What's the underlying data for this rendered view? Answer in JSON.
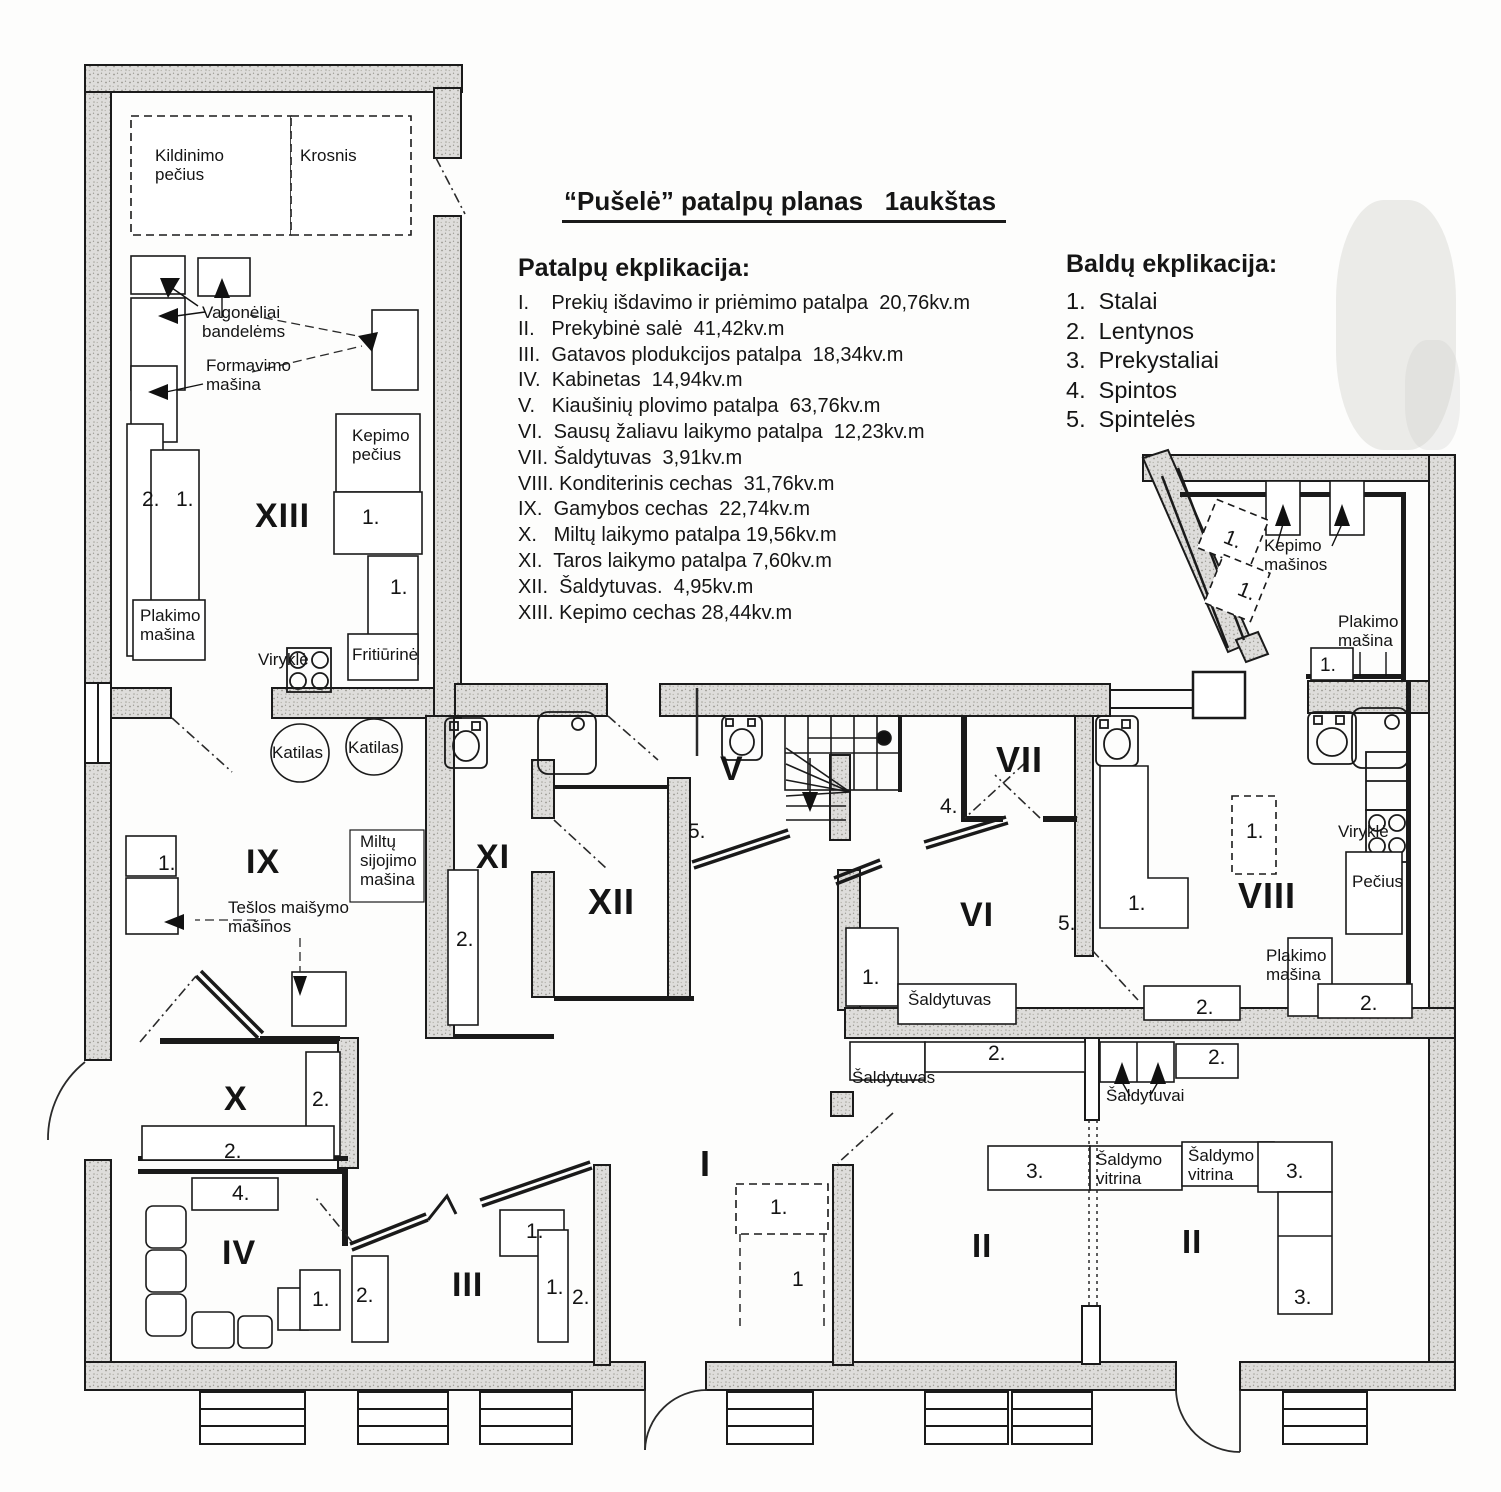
{
  "title": "“Pušelė” patalpų planas   1aukštas",
  "rooms_legend": {
    "heading": "Patalpų ekplikacija:",
    "items": [
      "I.    Prekių išdavimo ir priėmimo patalpa  20,76kv.m",
      "II.   Prekybinė salė  41,42kv.m",
      "III.  Gatavos plodukcijos patalpa  18,34kv.m",
      "IV.  Kabinetas  14,94kv.m",
      "V.   Kiaušinių plovimo patalpa  63,76kv.m",
      "VI.  Sausų žaliavu laikymo patalpa  12,23kv.m",
      "VII. Šaldytuvas  3,91kv.m",
      "VIII. Konditerinis cechas  31,76kv.m",
      "IX.  Gamybos cechas  22,74kv.m",
      "X.   Miltų laikymo patalpa 19,56kv.m",
      "XI.  Taros laikymo patalpa 7,60kv.m",
      "XII.  Šaldytuvas.  4,95kv.m",
      "XIII. Kepimo cechas 28,44kv.m"
    ]
  },
  "furniture_legend": {
    "heading": "Baldų ekplikacija:",
    "items": [
      "1.  Stalai",
      "2.  Lentynos",
      "3.  Prekystaliai",
      "4.  Spintos",
      "5.  Spintelės"
    ]
  },
  "room_labels": [
    {
      "name": "room-XIII",
      "text": "XIII",
      "x": 255,
      "y": 497,
      "fs": 34,
      "b": 1
    },
    {
      "name": "room-IX",
      "text": "IX",
      "x": 246,
      "y": 843,
      "fs": 34,
      "b": 1
    },
    {
      "name": "room-X",
      "text": "X",
      "x": 224,
      "y": 1080,
      "fs": 34,
      "b": 1
    },
    {
      "name": "room-IV",
      "text": "IV",
      "x": 222,
      "y": 1234,
      "fs": 34,
      "b": 1
    },
    {
      "name": "room-III",
      "text": "III",
      "x": 452,
      "y": 1266,
      "fs": 34,
      "b": 1
    },
    {
      "name": "room-XI",
      "text": "XI",
      "x": 476,
      "y": 838,
      "fs": 34,
      "b": 1
    },
    {
      "name": "room-XII",
      "text": "XII",
      "x": 588,
      "y": 882,
      "fs": 36,
      "b": 1
    },
    {
      "name": "room-V",
      "text": "V",
      "x": 720,
      "y": 750,
      "fs": 34,
      "b": 1
    },
    {
      "name": "room-VI",
      "text": "VI",
      "x": 960,
      "y": 896,
      "fs": 34,
      "b": 1
    },
    {
      "name": "room-VII",
      "text": "VII",
      "x": 996,
      "y": 740,
      "fs": 36,
      "b": 1
    },
    {
      "name": "room-VIII",
      "text": "VIII",
      "x": 1238,
      "y": 876,
      "fs": 36,
      "b": 1
    },
    {
      "name": "room-I",
      "text": "I",
      "x": 700,
      "y": 1144,
      "fs": 36,
      "b": 1
    },
    {
      "name": "room-II-left",
      "text": "II",
      "x": 972,
      "y": 1228,
      "fs": 33,
      "b": 1
    },
    {
      "name": "room-II-right",
      "text": "II",
      "x": 1182,
      "y": 1224,
      "fs": 33,
      "b": 1
    }
  ],
  "equipment_labels": [
    {
      "name": "lbl-kildinimo-pecius",
      "text": "Kildinimo\npečius",
      "x": 155,
      "y": 146
    },
    {
      "name": "lbl-krosnis",
      "text": "Krosnis",
      "x": 300,
      "y": 146
    },
    {
      "name": "lbl-vagoneliai",
      "text": "Vagonėliai\nbandelėms",
      "x": 202,
      "y": 303
    },
    {
      "name": "lbl-formavimo-masina",
      "text": "Formavimo\nmašina",
      "x": 206,
      "y": 356
    },
    {
      "name": "lbl-kepimo-pecius",
      "text": "Kepimo\npečius",
      "x": 352,
      "y": 426
    },
    {
      "name": "lbl-plakimo-masina-left",
      "text": "Plakimo\nmašina",
      "x": 140,
      "y": 606
    },
    {
      "name": "lbl-virykle-left",
      "text": "Viryklė",
      "x": 258,
      "y": 650
    },
    {
      "name": "lbl-fritiurine",
      "text": "Fritiūrinė",
      "x": 352,
      "y": 645
    },
    {
      "name": "lbl-katilas-1",
      "text": "Katilas",
      "x": 272,
      "y": 743
    },
    {
      "name": "lbl-katilas-2",
      "text": "Katilas",
      "x": 348,
      "y": 738
    },
    {
      "name": "lbl-miltu-sijojimo",
      "text": "Miltų\nsijojimo\nmašina",
      "x": 360,
      "y": 832
    },
    {
      "name": "lbl-teslos-maisymo",
      "text": "Tešlos maišymo\nmašinos",
      "x": 228,
      "y": 898
    },
    {
      "name": "lbl-saldytuvas-vi",
      "text": "Šaldytuvas",
      "x": 908,
      "y": 990
    },
    {
      "name": "lbl-saldytuvas-ii",
      "text": "Šaldytuvas",
      "x": 852,
      "y": 1068
    },
    {
      "name": "lbl-saldytuvai",
      "text": "Šaldytuvai",
      "x": 1106,
      "y": 1086
    },
    {
      "name": "lbl-saldymo-vitrina-1",
      "text": "Šaldymo\nvitrina",
      "x": 1096,
      "y": 1150
    },
    {
      "name": "lbl-saldymo-vitrina-2",
      "text": "Šaldymo\nvitrina",
      "x": 1188,
      "y": 1146
    },
    {
      "name": "lbl-kepimo-masinos",
      "text": "Kepimo\nmašinos",
      "x": 1264,
      "y": 536
    },
    {
      "name": "lbl-plakimo-masina-rt",
      "text": "Plakimo\nmašina",
      "x": 1338,
      "y": 612
    },
    {
      "name": "lbl-virykle-right",
      "text": "Viryklė",
      "x": 1338,
      "y": 822
    },
    {
      "name": "lbl-pecius",
      "text": "Pečius",
      "x": 1352,
      "y": 872
    },
    {
      "name": "lbl-plakimo-masina-rb",
      "text": "Plakimo\nmašina",
      "x": 1266,
      "y": 946
    }
  ],
  "number_labels": [
    {
      "text": "2.",
      "x": 142,
      "y": 488
    },
    {
      "text": "1.",
      "x": 176,
      "y": 488
    },
    {
      "text": "1.",
      "x": 362,
      "y": 506
    },
    {
      "text": "1.",
      "x": 390,
      "y": 576
    },
    {
      "text": "1.",
      "x": 158,
      "y": 852
    },
    {
      "text": "2.",
      "x": 456,
      "y": 928
    },
    {
      "text": "5.",
      "x": 688,
      "y": 820
    },
    {
      "text": "5.",
      "x": 1058,
      "y": 912
    },
    {
      "text": "4.",
      "x": 940,
      "y": 795
    },
    {
      "text": "1.",
      "x": 862,
      "y": 966
    },
    {
      "text": "1.",
      "x": 1128,
      "y": 892
    },
    {
      "text": "2.",
      "x": 1196,
      "y": 996
    },
    {
      "text": "2.",
      "x": 988,
      "y": 1042
    },
    {
      "text": "2.",
      "x": 1208,
      "y": 1046
    },
    {
      "text": "1.",
      "x": 1246,
      "y": 820
    },
    {
      "text": "1.",
      "x": 1320,
      "y": 655,
      "fs": 19
    },
    {
      "text": "2.",
      "x": 1360,
      "y": 992
    },
    {
      "text": "1.",
      "x": 1224,
      "y": 528,
      "r": 22
    },
    {
      "text": "1.",
      "x": 1238,
      "y": 580,
      "r": 22
    },
    {
      "text": "2.",
      "x": 312,
      "y": 1088
    },
    {
      "text": "2.",
      "x": 224,
      "y": 1140
    },
    {
      "text": "4.",
      "x": 232,
      "y": 1182
    },
    {
      "text": "1.",
      "x": 312,
      "y": 1288
    },
    {
      "text": "2.",
      "x": 356,
      "y": 1284
    },
    {
      "text": "1.",
      "x": 526,
      "y": 1220
    },
    {
      "text": "1.",
      "x": 546,
      "y": 1276
    },
    {
      "text": "2.",
      "x": 572,
      "y": 1286
    },
    {
      "text": "1.",
      "x": 770,
      "y": 1196
    },
    {
      "text": "1",
      "x": 792,
      "y": 1268
    },
    {
      "text": "3.",
      "x": 1026,
      "y": 1160
    },
    {
      "text": "3.",
      "x": 1286,
      "y": 1160
    },
    {
      "text": "3.",
      "x": 1294,
      "y": 1286
    }
  ]
}
